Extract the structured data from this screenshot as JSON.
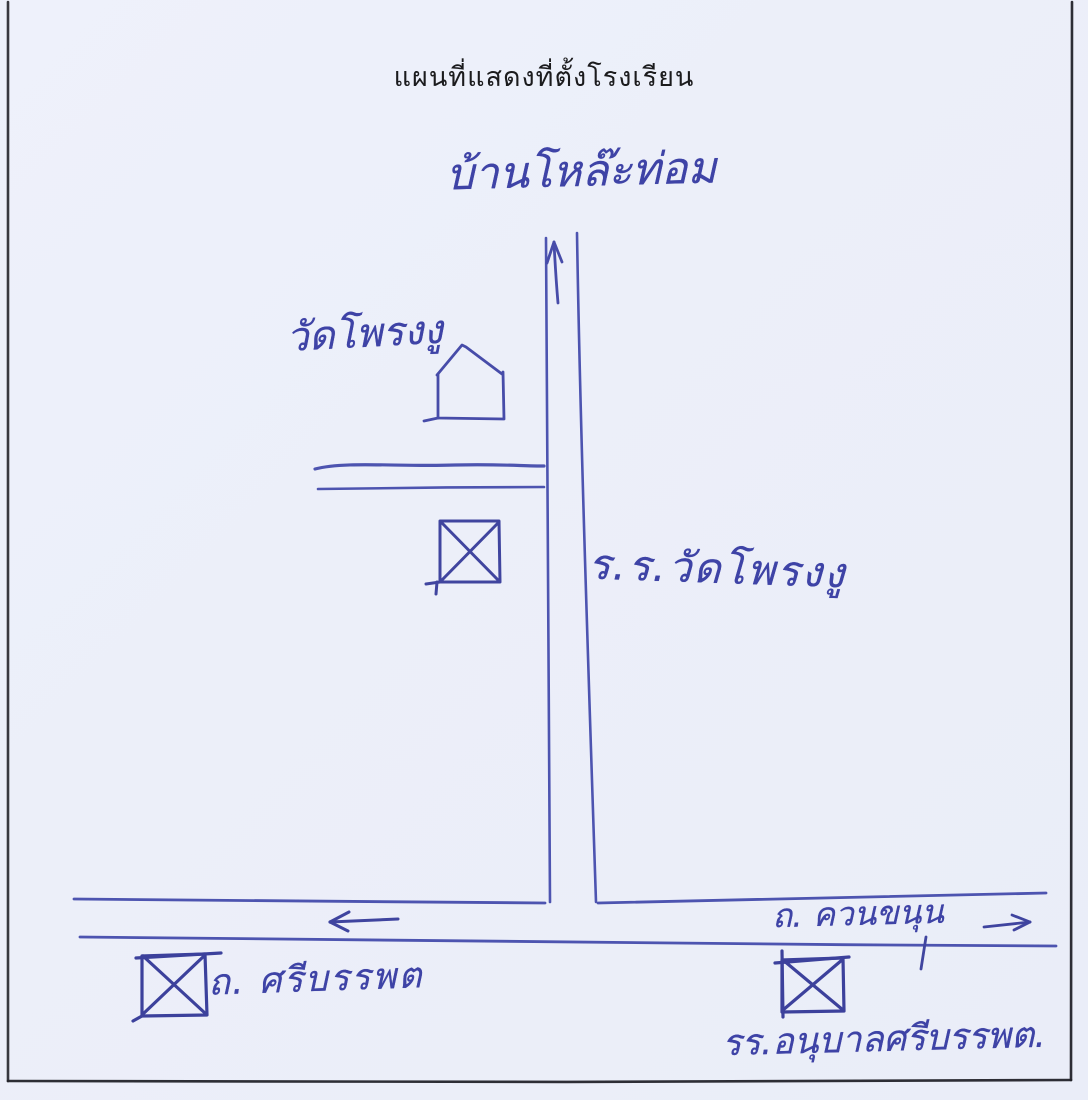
{
  "page": {
    "background_color": "#edf0fa",
    "frame_color": "#23232a",
    "title": "แผนที่แสดงที่ตั้งโรงเรียน",
    "title_color": "#1b1b1d"
  },
  "map": {
    "ink_color": "#3e43a6",
    "stroke_color": "#4d54b0",
    "labels": {
      "village_top": "บ้านโหล๊ะท่อม",
      "temple": "วัดโพรงงู",
      "school_main": "ร.ร.วัดโพรงงู",
      "road_khuan_khanun": "ถ. ควนขนุน",
      "road_si_banphot": "ถ. ศรีบรรพต",
      "school_anuban": "รร.อนุบาลศรีบรรพต."
    },
    "symbols": {
      "up_arrow": "arrow-up-icon",
      "left_arrow": "arrow-left-icon",
      "right_arrow": "arrow-right-icon",
      "temple_house": "house-outline-icon",
      "x_box_temple": "crossed-box-marker",
      "x_box_left": "crossed-box-marker",
      "x_box_right": "crossed-box-marker"
    }
  }
}
